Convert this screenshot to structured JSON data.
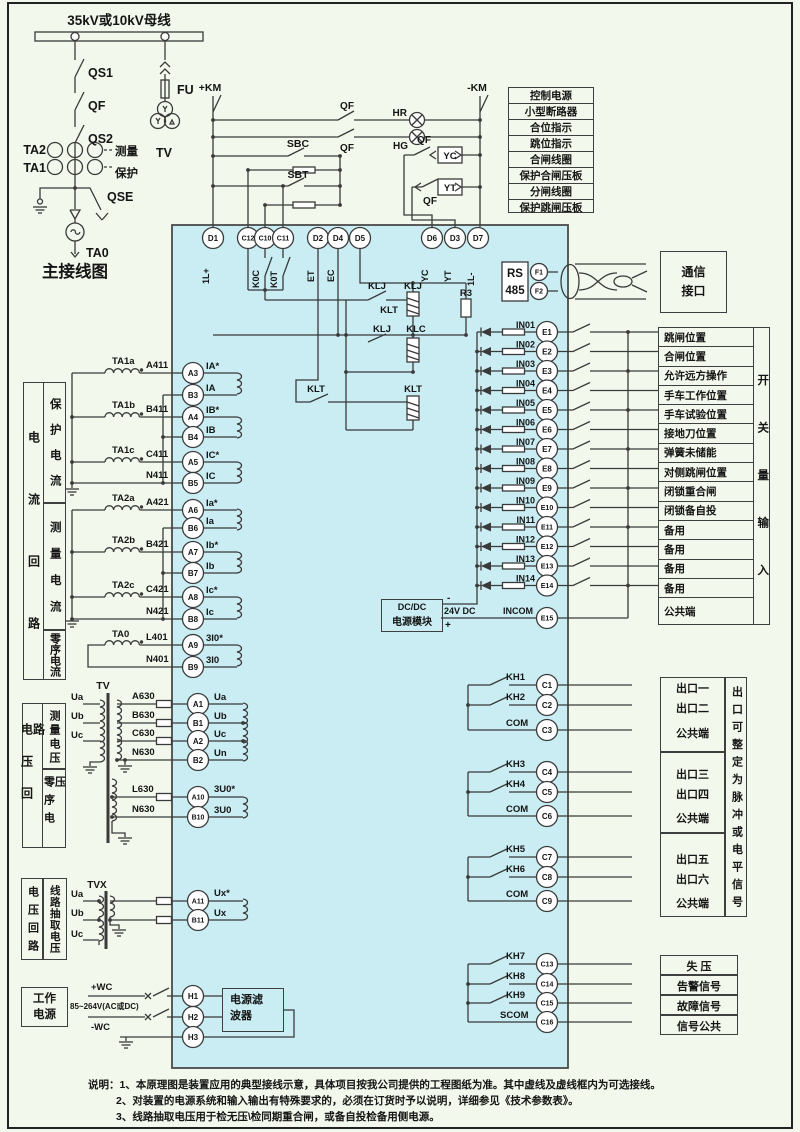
{
  "colors": {
    "background": "#f2f8ec",
    "device_fill": "#c9edf3",
    "line": "#3a3a3a"
  },
  "main_diagram": {
    "bus_label": "35kV或10kV母线",
    "qs1": "QS1",
    "qf": "QF",
    "qs2": "QS2",
    "ta2": "TA2",
    "ta1": "TA1",
    "measure": "测量",
    "protection": "保护",
    "fu": "FU",
    "tv": "TV",
    "qse": "QSE",
    "ta0": "TA0",
    "title": "主接线图"
  },
  "control": {
    "km_pos": "+KM",
    "km_neg": "-KM",
    "qf_top": "QF",
    "hr": "HR",
    "qf_mid": "QF",
    "hg": "HG",
    "sbc": "SBC",
    "sbt": "SBT",
    "yc": "YC",
    "yt": "YT",
    "qf_yc": "QF",
    "qf_yt": "QF"
  },
  "relays": {
    "k0c": "K0C",
    "k0t": "K0T",
    "klj_contact_upper": "KLJ",
    "klj_coil": "KLJ",
    "klt_mid": "KLT",
    "klj_contact_lower": "KLJ",
    "klc_coil": "KLC",
    "r3": "R3",
    "klt_contact": "KLT",
    "klt_coil": "KLT"
  },
  "legend_top": [
    "控制电源",
    "小型断路器",
    "合位指示",
    "跳位指示",
    "合闸线圈",
    "保护合闸压板",
    "分闸线圈",
    "保护跳闸压板"
  ],
  "top_terminals": [
    {
      "id": "D1",
      "tag": "1L+"
    },
    {
      "id": "C12",
      "tag": ""
    },
    {
      "id": "C10",
      "tag": ""
    },
    {
      "id": "C11",
      "tag": ""
    },
    {
      "id": "D2",
      "tag": "ET"
    },
    {
      "id": "D4",
      "tag": "EC"
    },
    {
      "id": "D5",
      "tag": ""
    },
    {
      "id": "D6",
      "tag": "YC"
    },
    {
      "id": "D3",
      "tag": "YT"
    },
    {
      "id": "D7",
      "tag": "1L-"
    }
  ],
  "comm": {
    "rs_line1": "RS",
    "rs_line2": "485",
    "f1": "F1",
    "f2": "F2",
    "port_line1": "通信",
    "port_line2": "接口"
  },
  "current_section": {
    "sidebar_outer": "电流回路",
    "sidebar_sections": [
      "保护电流",
      "测量电流",
      "零序电流"
    ],
    "rows": [
      {
        "ct": "TA1a",
        "wire": "A411",
        "terminal": "A3",
        "signal": "IA*"
      },
      {
        "ct": "",
        "wire": "",
        "terminal": "B3",
        "signal": "IA"
      },
      {
        "ct": "TA1b",
        "wire": "B411",
        "terminal": "A4",
        "signal": "IB*"
      },
      {
        "ct": "",
        "wire": "",
        "terminal": "B4",
        "signal": "IB"
      },
      {
        "ct": "TA1c",
        "wire": "C411",
        "terminal": "A5",
        "signal": "IC*"
      },
      {
        "ct": "",
        "wire": "N411",
        "terminal": "B5",
        "signal": "IC"
      },
      {
        "ct": "TA2a",
        "wire": "A421",
        "terminal": "A6",
        "signal": "Ia*"
      },
      {
        "ct": "",
        "wire": "",
        "terminal": "B6",
        "signal": "Ia"
      },
      {
        "ct": "TA2b",
        "wire": "B421",
        "terminal": "A7",
        "signal": "Ib*"
      },
      {
        "ct": "",
        "wire": "",
        "terminal": "B7",
        "signal": "Ib"
      },
      {
        "ct": "TA2c",
        "wire": "C421",
        "terminal": "A8",
        "signal": "Ic*"
      },
      {
        "ct": "",
        "wire": "N421",
        "terminal": "B8",
        "signal": "Ic"
      },
      {
        "ct": "TA0",
        "wire": "L401",
        "terminal": "A9",
        "signal": "3I0*"
      },
      {
        "ct": "",
        "wire": "N401",
        "terminal": "B9",
        "signal": "3I0"
      }
    ]
  },
  "voltage_section": {
    "sidebar_outer": "电压回路",
    "sidebar_sections": [
      "测量电压",
      "零序电压"
    ],
    "tv_label": "TV",
    "phases": [
      "Ua",
      "Ub",
      "Uc"
    ],
    "rows": [
      {
        "wire": "A630",
        "terminal": "A1",
        "signal": "Ua"
      },
      {
        "wire": "B630",
        "terminal": "B1",
        "signal": "Ub"
      },
      {
        "wire": "C630",
        "terminal": "A2",
        "signal": "Uc"
      },
      {
        "wire": "N630",
        "terminal": "B2",
        "signal": "Un"
      },
      {
        "wire": "L630",
        "terminal": "A10",
        "signal": "3U0*"
      },
      {
        "wire": "N630",
        "terminal": "B10",
        "signal": "3U0"
      }
    ]
  },
  "tvx_section": {
    "sidebar_outer": "电压回路",
    "sidebar_sections": [
      "线路抽取电压"
    ],
    "tvx_label": "TVX",
    "phases": [
      "Ua",
      "Ub",
      "Uc"
    ],
    "rows": [
      {
        "terminal": "A11",
        "signal": "Ux*"
      },
      {
        "terminal": "B11",
        "signal": "Ux"
      }
    ]
  },
  "power_section": {
    "box_line1": "工作",
    "box_line2": "电源",
    "pos_wire": "+WC",
    "voltage_range": "85~264V(AC或DC)",
    "neg_wire": "-WC",
    "terminals": [
      "H1",
      "H2",
      "H3"
    ],
    "filter_line1": "电源滤",
    "filter_line2": "波器"
  },
  "dcdc": {
    "line1": "DC/DC",
    "line2": "电源模块",
    "output": "24V DC",
    "plus": "+",
    "minus": "-"
  },
  "di_section": {
    "rows": [
      {
        "input": "IN01",
        "terminal": "E1"
      },
      {
        "input": "IN02",
        "terminal": "E2"
      },
      {
        "input": "IN03",
        "terminal": "E3"
      },
      {
        "input": "IN04",
        "terminal": "E4"
      },
      {
        "input": "IN05",
        "terminal": "E5"
      },
      {
        "input": "IN06",
        "terminal": "E6"
      },
      {
        "input": "IN07",
        "terminal": "E7"
      },
      {
        "input": "IN08",
        "terminal": "E8"
      },
      {
        "input": "IN09",
        "terminal": "E9"
      },
      {
        "input": "IN10",
        "terminal": "E10"
      },
      {
        "input": "IN11",
        "terminal": "E11"
      },
      {
        "input": "IN12",
        "terminal": "E12"
      },
      {
        "input": "IN13",
        "terminal": "E13"
      },
      {
        "input": "IN14",
        "terminal": "E14"
      }
    ],
    "incom": {
      "input": "INCOM",
      "terminal": "E15"
    },
    "table_rows": [
      "跳闸位置",
      "合闸位置",
      "允许远方操作",
      "手车工作位置",
      "手车试验位置",
      "接地刀位置",
      "弹簧未储能",
      "对侧跳闸位置",
      "闭锁重合闸",
      "闭锁备自投",
      "备用",
      "备用",
      "备用",
      "备用",
      "公共端"
    ],
    "sidebar": "开关量输入"
  },
  "do_section": {
    "groups": [
      {
        "contacts": [
          "KH1",
          "KH2",
          "COM"
        ],
        "terminals": [
          "C1",
          "C2",
          "C3"
        ],
        "labels": [
          "出口一",
          "出口二",
          "公共端"
        ]
      },
      {
        "contacts": [
          "KH3",
          "KH4",
          "COM"
        ],
        "terminals": [
          "C4",
          "C5",
          "C6"
        ],
        "labels": [
          "出口三",
          "出口四",
          "公共端"
        ]
      },
      {
        "contacts": [
          "KH5",
          "KH6",
          "COM"
        ],
        "terminals": [
          "C7",
          "C8",
          "C9"
        ],
        "labels": [
          "出口五",
          "出口六",
          "公共端"
        ]
      }
    ],
    "sidebar": "出口可整定为脉冲或电平信号",
    "signal_group": {
      "contacts": [
        "KH7",
        "KH8",
        "KH9",
        "SCOM"
      ],
      "terminals": [
        "C13",
        "C14",
        "C15",
        "C16"
      ],
      "labels": [
        "失  压",
        "告警信号",
        "故障信号",
        "信号公共"
      ]
    }
  },
  "notes": [
    "说明：1、本原理图是装置应用的典型接线示意，具体项目按我公司提供的工程图纸为准。其中虚线及虚线框内为可选接线。",
    "2、对装置的电源系统和输入输出有特殊要求的，必须在订货时予以说明，详细参见《技术参数表》。",
    "3、线路抽取电压用于检无压\\检同期重合闸，或备自投检备用侧电源。"
  ]
}
